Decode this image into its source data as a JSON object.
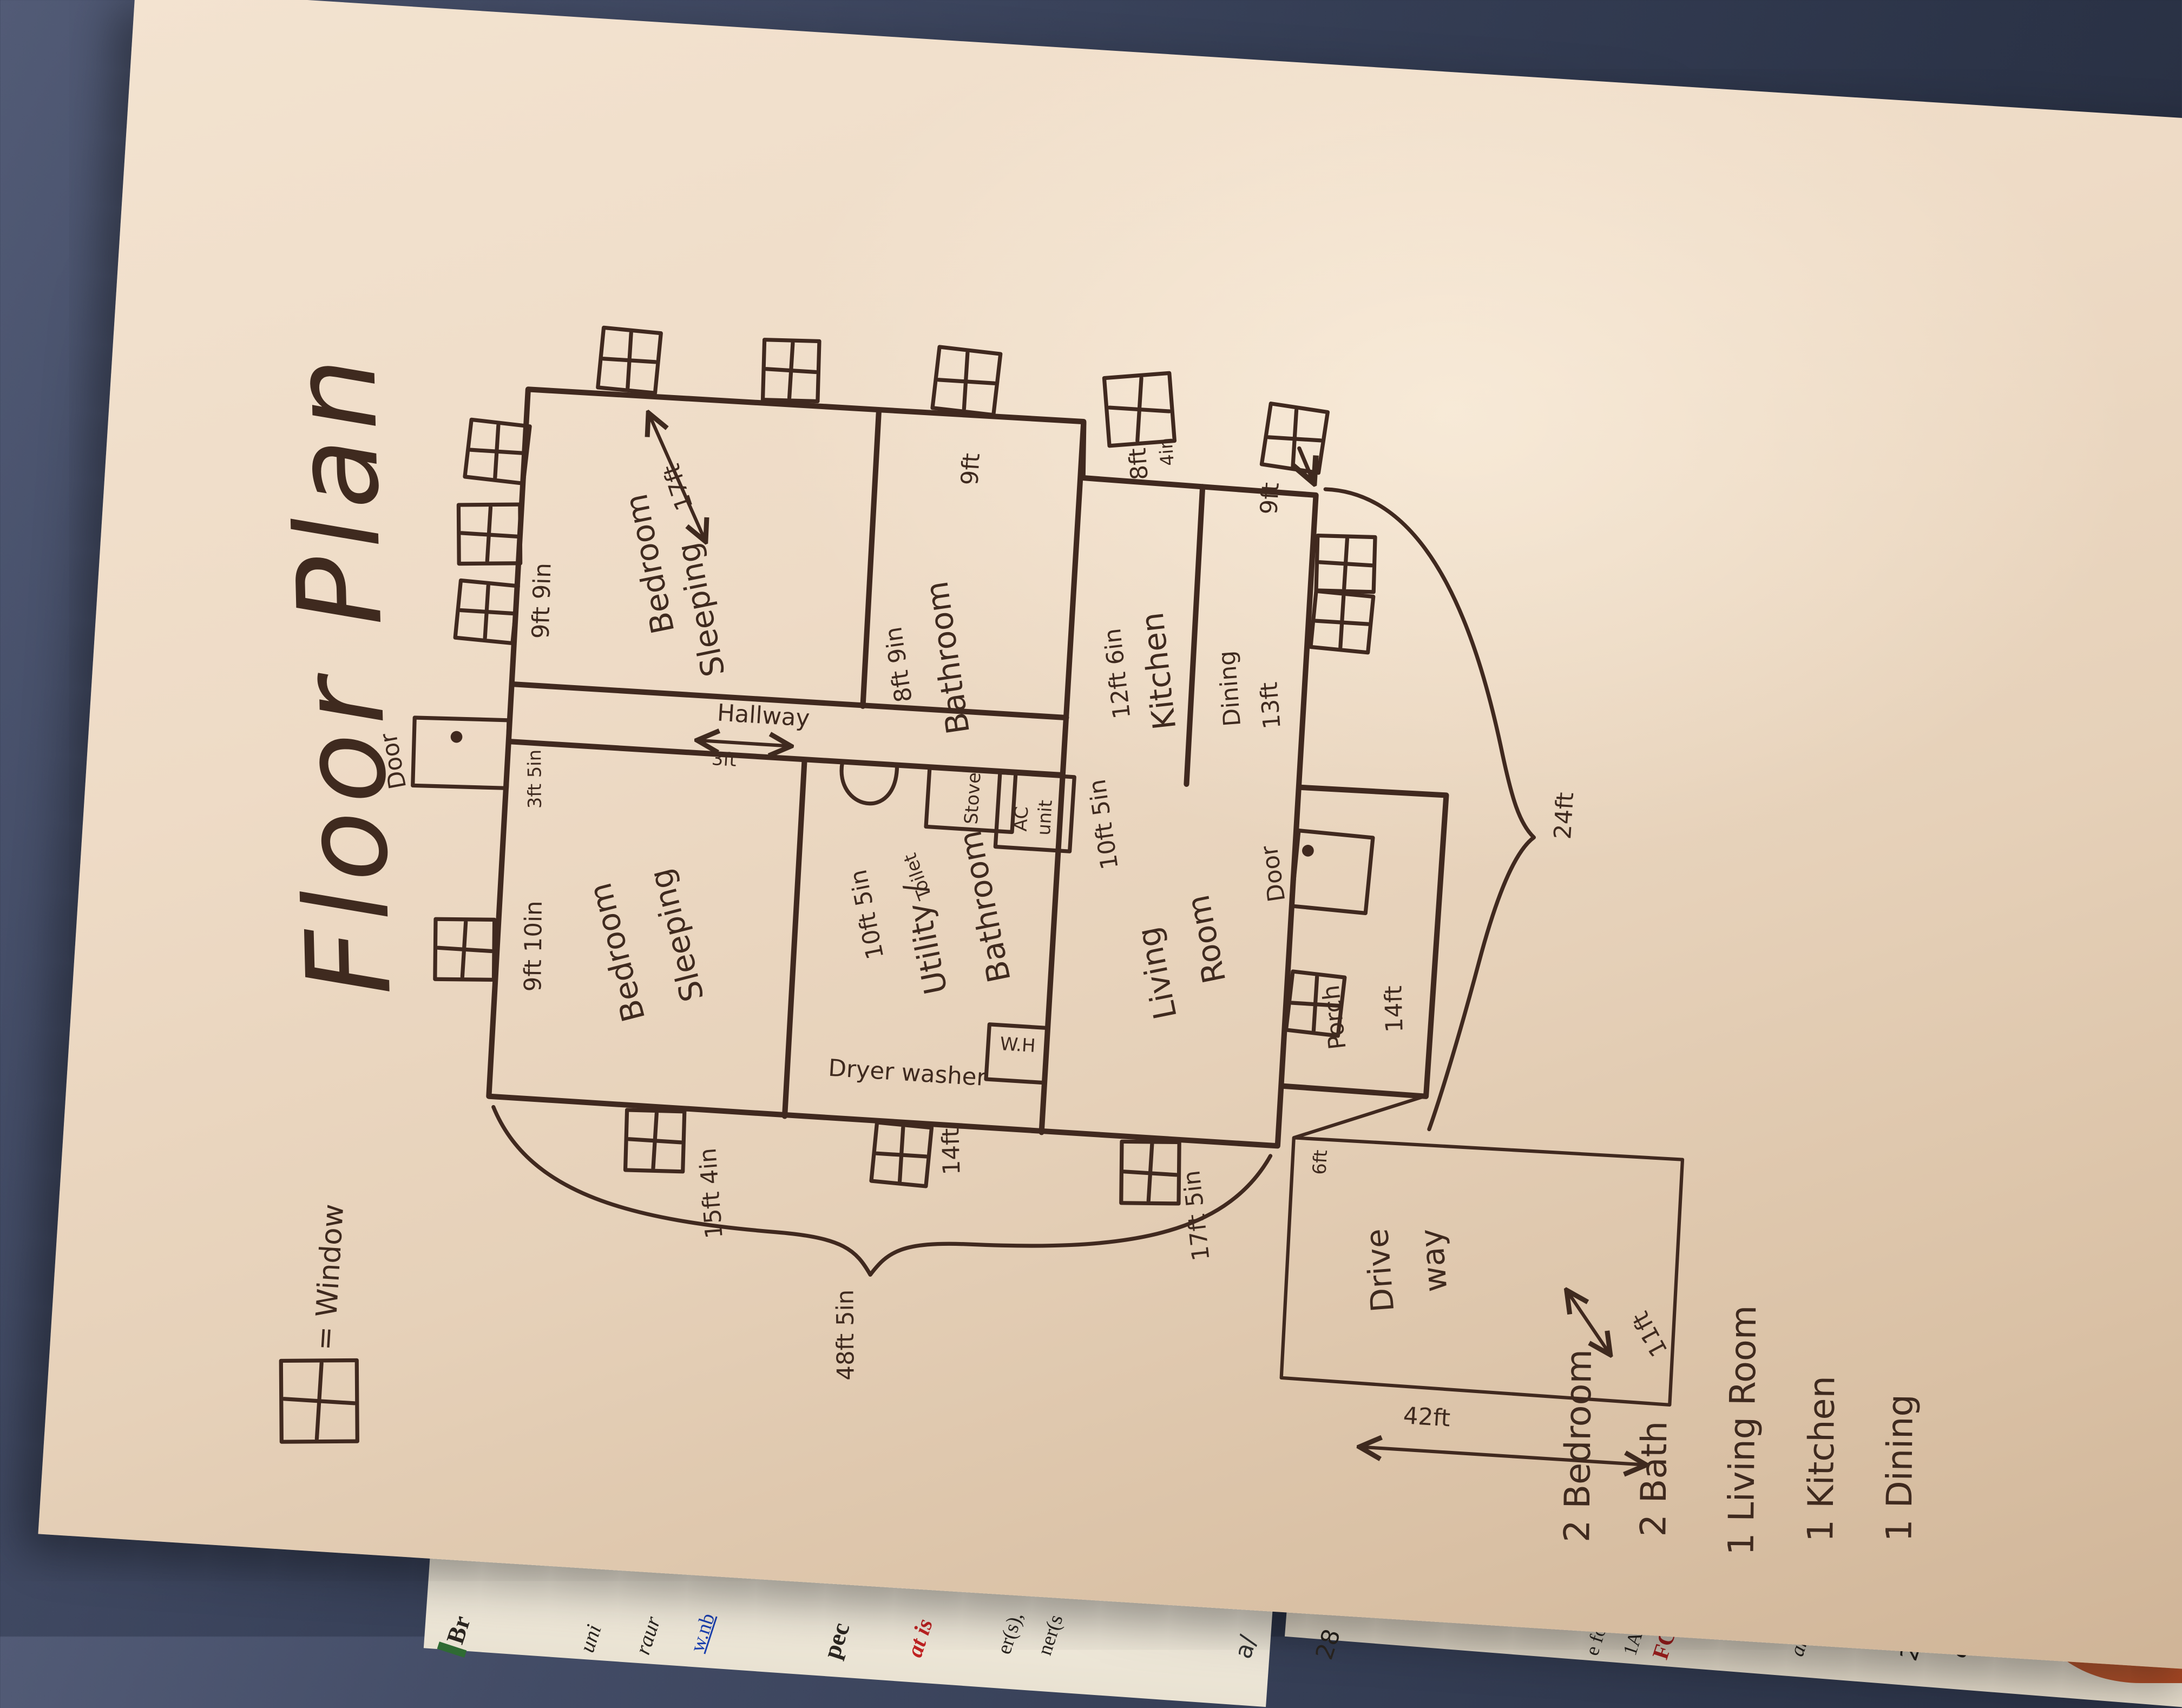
{
  "title": "Floor Plan",
  "legend": {
    "label": "= Window"
  },
  "rooms": {
    "bedroom1": {
      "line1": "Bedroom",
      "line2": "Sleeping",
      "width": "9ft 9in",
      "length": "17ft"
    },
    "bathroom1": {
      "name": "Bathroom",
      "width": "8ft 9in"
    },
    "kitchen": {
      "name": "Kitchen",
      "width": "12ft 6in"
    },
    "dining": {
      "name": "Dining",
      "width": "13ft"
    },
    "bedroom2": {
      "line1": "Bedroom",
      "line2": "Sleeping",
      "width": "9ft 10in",
      "side": "15ft 4in"
    },
    "utility": {
      "line1": "Utility /",
      "line2": "Bathroom",
      "width": "10ft 5in",
      "side": "14ft"
    },
    "living": {
      "line1": "Living",
      "line2": "Room",
      "width": "10ft 5in",
      "side": "17ft 5in"
    },
    "porch": {
      "name": "Porch",
      "width": "14ft",
      "depth": "6ft"
    },
    "hallway": {
      "name": "Hallway",
      "width": "3ft"
    },
    "driveway": {
      "line1": "Drive",
      "line2": "way",
      "width": "11ft",
      "length": "42ft"
    }
  },
  "fixtures": {
    "toilet": "Toilet",
    "stove": "Stove",
    "ac1": "AC",
    "ac2": "unit",
    "water_heater": "W.H",
    "laundry": "Dryer washer"
  },
  "doors": {
    "front": "Door",
    "front_width": "3ft 5in",
    "porch": "Door"
  },
  "window_notes": {
    "n1a": "8ft",
    "n1b": "4in",
    "n2": "9ft"
  },
  "totals": {
    "length": "48ft 5in",
    "rear_width": "24ft"
  },
  "notes": [
    "2 Bedroom",
    "2 Bath",
    "1 Living Room",
    "1 Kitchen",
    "1 Dining"
  ],
  "fragments": [
    "Br",
    "uni",
    "raur",
    "w.nb",
    "pec",
    "at is",
    "er(s),",
    "ner(s",
    "a/",
    "28",
    "e fo",
    "1A-",
    "an",
    "ec",
    "FC",
    "2"
  ]
}
